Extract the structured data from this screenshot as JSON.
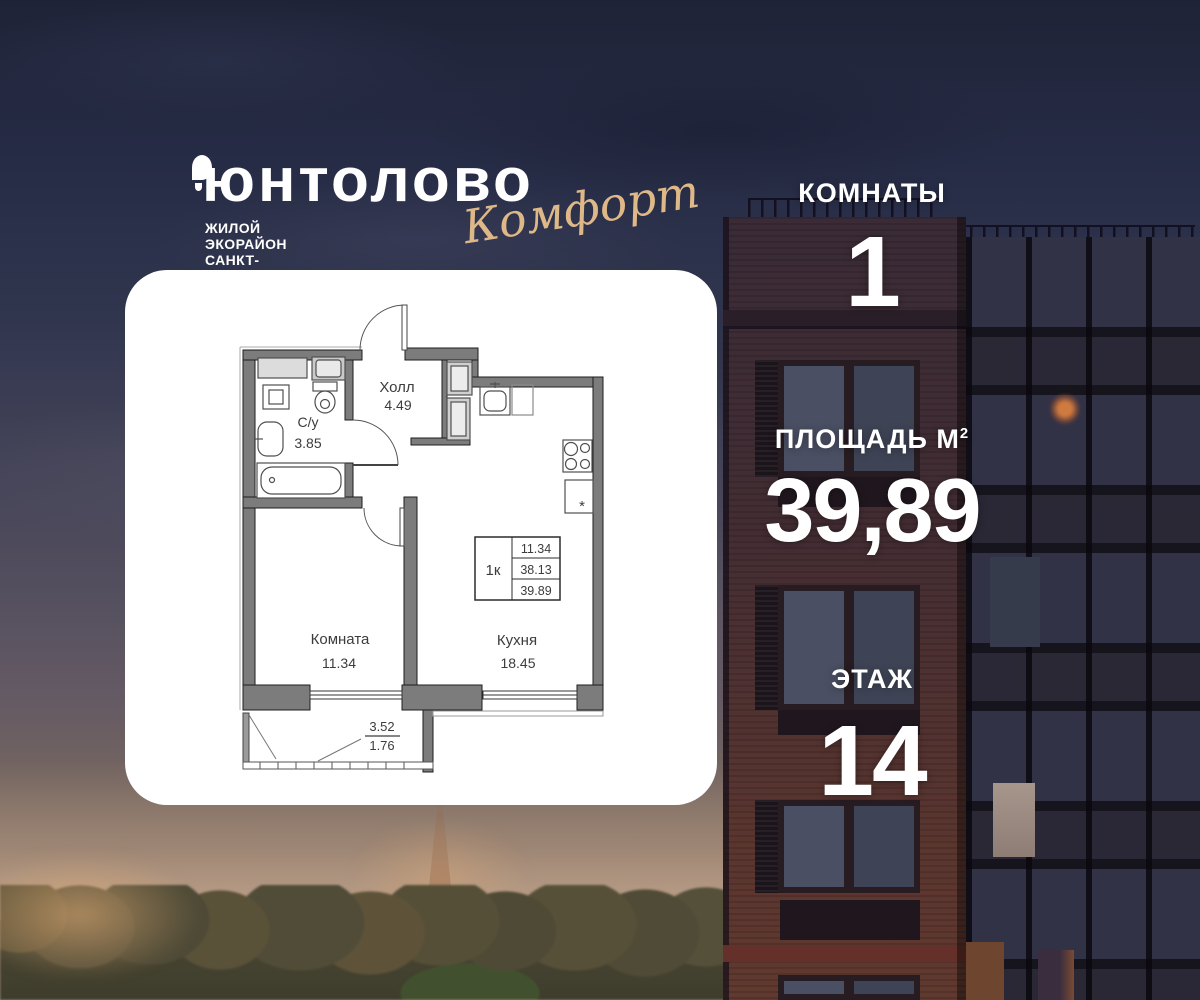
{
  "logo": {
    "brand": "юнтолово",
    "tagline": "ЖИЛОЙ ЭКОРАЙОН САНКТ-ПЕТЕРБУРГА",
    "edition": "Комфорт"
  },
  "stats": {
    "rooms": {
      "label": "КОМНАТЫ",
      "value": "1"
    },
    "area": {
      "label": "ПЛОЩАДЬ М",
      "sup": "2",
      "value": "39,89"
    },
    "floor": {
      "label": "ЭТАЖ",
      "value": "14"
    }
  },
  "floorplan": {
    "unit_table": {
      "type": "1к",
      "room_area": "11.34",
      "living_area": "38.13",
      "total_area": "39.89"
    },
    "rooms": {
      "hall": {
        "name": "Холл",
        "area": "4.49"
      },
      "bathroom": {
        "name": "С/у",
        "area": "3.85"
      },
      "room": {
        "name": "Комната",
        "area": "11.34"
      },
      "kitchen": {
        "name": "Кухня",
        "area": "18.45"
      }
    },
    "balcony": {
      "area_full": "3.52",
      "area_reduced": "1.76"
    }
  },
  "icons": {
    "freezer_star": "*"
  },
  "colors": {
    "accent_gold": "#dfb888",
    "card_bg": "#ffffff",
    "text_on_photo": "#ffffff",
    "plan_wall": "#7c7c7c",
    "plan_text": "#3c3c3c",
    "sky_top": "#1f2337",
    "brick": "#59352f"
  }
}
